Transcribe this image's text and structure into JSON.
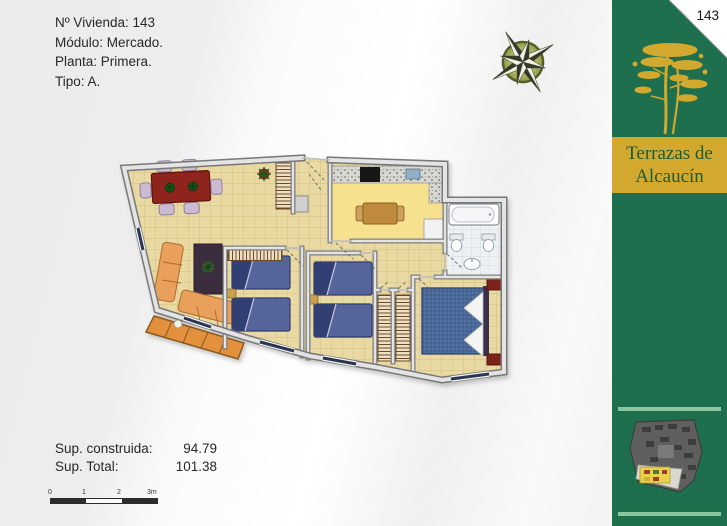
{
  "header": {
    "lines": [
      "Nº Vivienda: 143",
      "Módulo: Mercado.",
      "Planta: Primera.",
      "Tipo: A."
    ]
  },
  "stats": {
    "rows": [
      {
        "label": "Sup. construida:",
        "value": "94.79"
      },
      {
        "label": "Sup. Total:",
        "value": "101.38"
      }
    ]
  },
  "scale_bar": {
    "ticks": [
      "0",
      "1",
      "2",
      "3m"
    ]
  },
  "banner": {
    "page_number": "143",
    "title_line1": "Terrazas de",
    "title_line2": "Alcaucín",
    "colors": {
      "banner_green": "#1e6f4e",
      "logo_gold": "#d2a92e",
      "title_text_green": "#1b5c38",
      "accent_bar_green": "#8cc4a0"
    }
  },
  "floor_plan": {
    "colors": {
      "floor_beige": "#e9d9a2",
      "kitchen_yellow": "#f6e18f",
      "bathroom_white": "#eef1f1",
      "terrace_orange": "#e2903c",
      "bed_blue": "#55659c",
      "window_navy": "#2a3550",
      "dining_table_red": "#8e241c",
      "sofa_salmon": "#e8a05c",
      "wall_gray": "#7e7e7e"
    }
  }
}
